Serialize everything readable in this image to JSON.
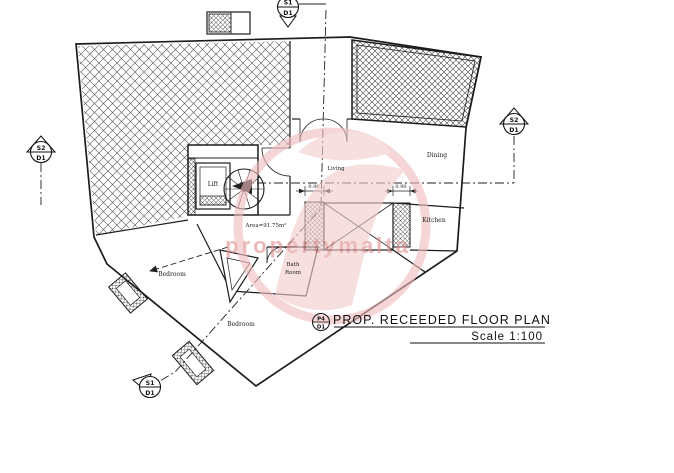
{
  "title_block": {
    "ref_upper": "P4",
    "ref_lower": "D1",
    "title": "PROP. RECEEDED FLOOR PLAN",
    "scale": "Scale 1:100"
  },
  "markers": {
    "top": {
      "upper": "S1",
      "lower": "D1"
    },
    "left": {
      "upper": "S2",
      "lower": "D1"
    },
    "right": {
      "upper": "S2",
      "lower": "D1"
    },
    "bottom": {
      "upper": "S1",
      "lower": "D1"
    }
  },
  "labels": {
    "lift": "Lift",
    "bedroom_left": "Bedroom",
    "bedroom_bottom": "Bedroom",
    "bath_line1": "Bath",
    "bath_line2": "Room",
    "kitchen": "Kitchen",
    "dining": "Dining",
    "living": "Living",
    "area": "Area=91.75m²"
  },
  "dimensions": {
    "shaft_left": "0.90",
    "shaft_right": "0.90"
  },
  "watermark": {
    "text": "propertymalta",
    "color": "#e08f8f"
  },
  "colors": {
    "ink": "#1c1c1c",
    "watermark_pink": "#f0bcbc"
  }
}
